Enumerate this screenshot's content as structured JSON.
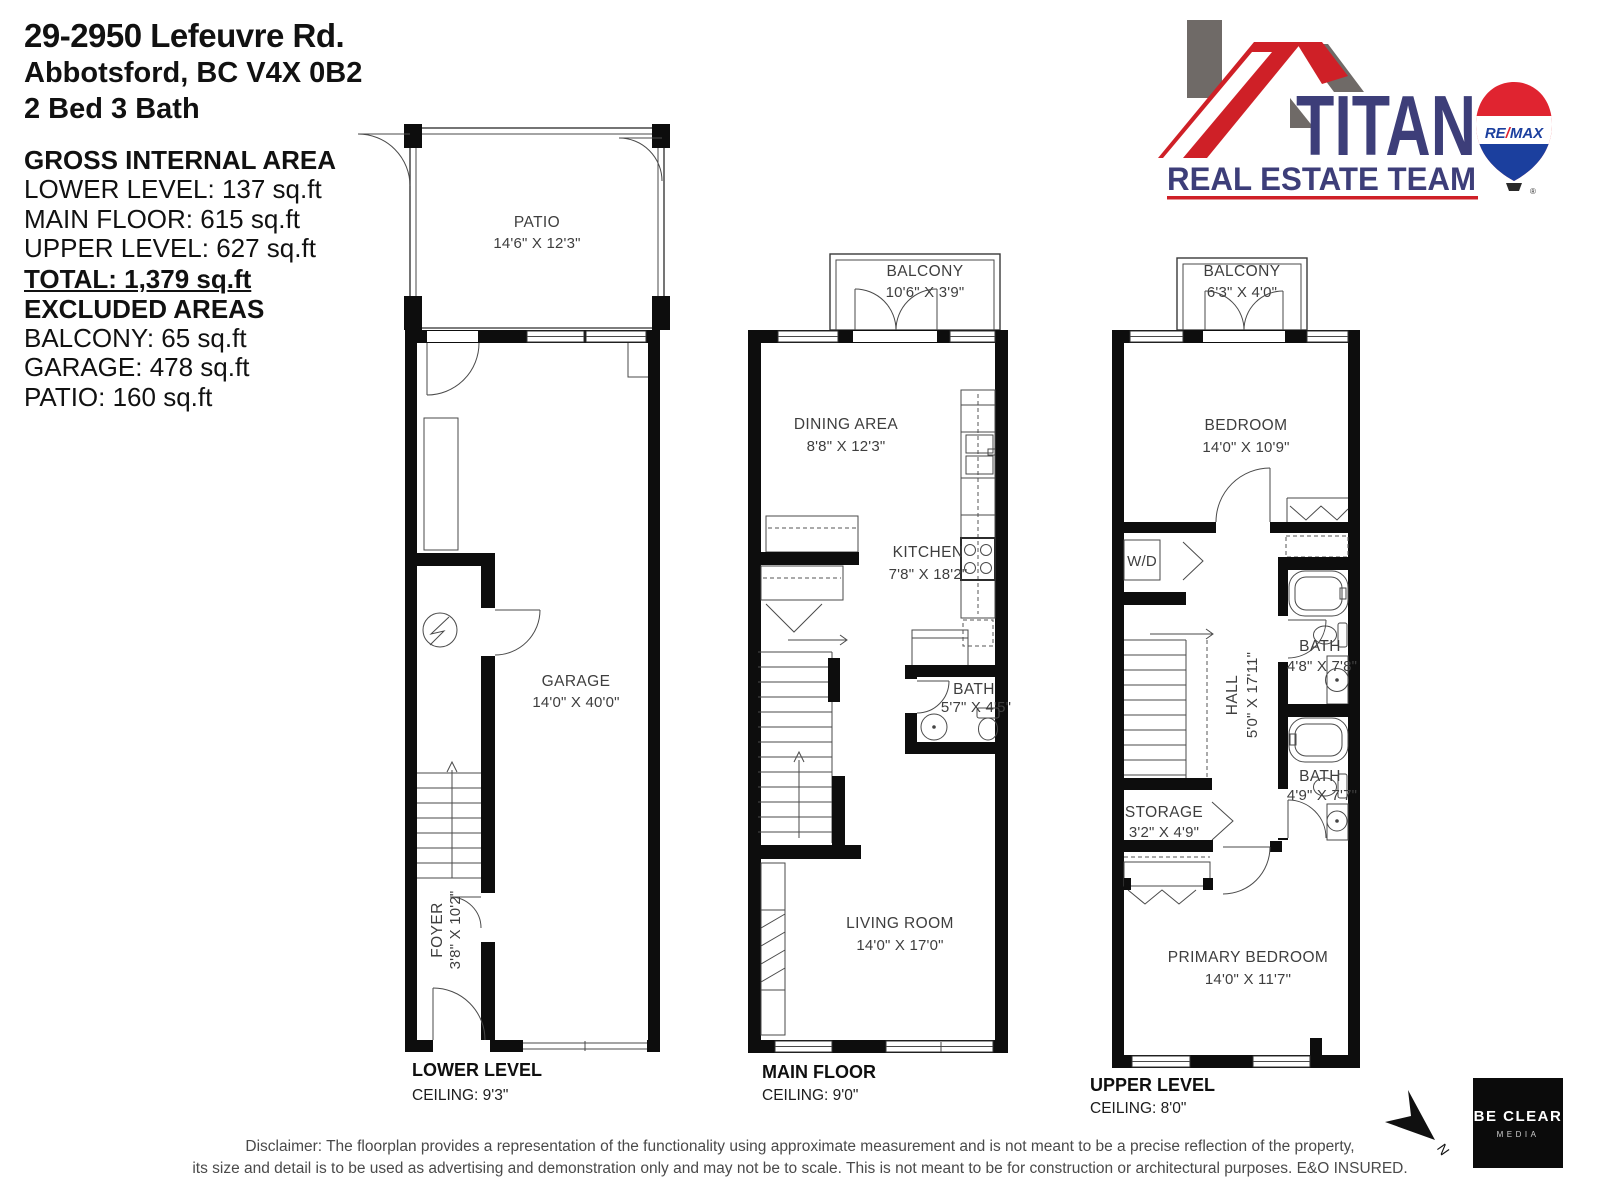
{
  "header": {
    "address_line1": "29-2950 Lefeuvre Rd.",
    "address_line2": "Abbotsford, BC V4X 0B2",
    "address_line3": "2 Bed 3 Bath",
    "gia_title": "GROSS INTERNAL AREA",
    "gia_items": [
      "LOWER LEVEL: 137 sq.ft",
      "MAIN FLOOR: 615 sq.ft",
      "UPPER LEVEL: 627 sq.ft"
    ],
    "total": "TOTAL: 1,379 sq.ft",
    "excluded_title": "EXCLUDED AREAS",
    "excluded_items": [
      "BALCONY: 65 sq.ft",
      "GARAGE: 478 sq.ft",
      "PATIO: 160 sq.ft"
    ]
  },
  "logo": {
    "brand": "TITAN",
    "subtitle": "REAL ESTATE TEAM",
    "balloon_text_left": "RE",
    "balloon_slash": "/",
    "balloon_text_right": "MAX",
    "registered": "®",
    "colors": {
      "navy": "#3d3e79",
      "red": "#cf2027",
      "roof_gray": "#6f6a67",
      "remax_red": "#e02430",
      "remax_blue": "#1b3f9e"
    }
  },
  "plans": {
    "lower": {
      "title": "LOWER LEVEL",
      "ceiling": "CEILING: 9'3\"",
      "patio": {
        "name": "PATIO",
        "dims": "14'6\" X 12'3\""
      },
      "garage": {
        "name": "GARAGE",
        "dims": "14'0\" X 40'0\""
      },
      "foyer": {
        "name": "FOYER",
        "dims": "3'8\" X 10'2\""
      }
    },
    "main": {
      "title": "MAIN FLOOR",
      "ceiling": "CEILING: 9'0\"",
      "balcony": {
        "name": "BALCONY",
        "dims": "10'6\" X 3'9\""
      },
      "dining": {
        "name": "DINING AREA",
        "dims": "8'8\" X 12'3\""
      },
      "kitchen": {
        "name": "KITCHEN",
        "dims": "7'8\" X 18'2\""
      },
      "bath": {
        "name": "BATH",
        "dims": "5'7\" X 4'5\""
      },
      "living": {
        "name": "LIVING ROOM",
        "dims": "14'0\" X 17'0\""
      }
    },
    "upper": {
      "title": "UPPER LEVEL",
      "ceiling": "CEILING: 8'0\"",
      "balcony": {
        "name": "BALCONY",
        "dims": "6'3\" X 4'0\""
      },
      "bedroom": {
        "name": "BEDROOM",
        "dims": "14'0\" X 10'9\""
      },
      "wd": {
        "name": "W/D"
      },
      "hall": {
        "name": "HALL",
        "dims": "5'0\" X 17'11\""
      },
      "bath1": {
        "name": "BATH",
        "dims": "4'8\" X 7'8\""
      },
      "bath2": {
        "name": "BATH",
        "dims": "4'9\" X 7'7\""
      },
      "storage": {
        "name": "STORAGE",
        "dims": "3'2\" X 4'9\""
      },
      "primary": {
        "name": "PRIMARY BEDROOM",
        "dims": "14'0\" X 11'7\""
      }
    }
  },
  "footer": {
    "disclaimer_line1": "Disclaimer: The floorplan provides a representation of the functionality using approximate measurement and is not meant to be a precise reflection of the property,",
    "disclaimer_line2": "its size and detail is to be used as advertising and demonstration only and may not be to scale. This is not meant to be for construction or architectural purposes. E&O INSURED.",
    "compass_label": "N",
    "media_logo": {
      "line1": "BE CLEAR",
      "line2": "MEDIA"
    }
  }
}
